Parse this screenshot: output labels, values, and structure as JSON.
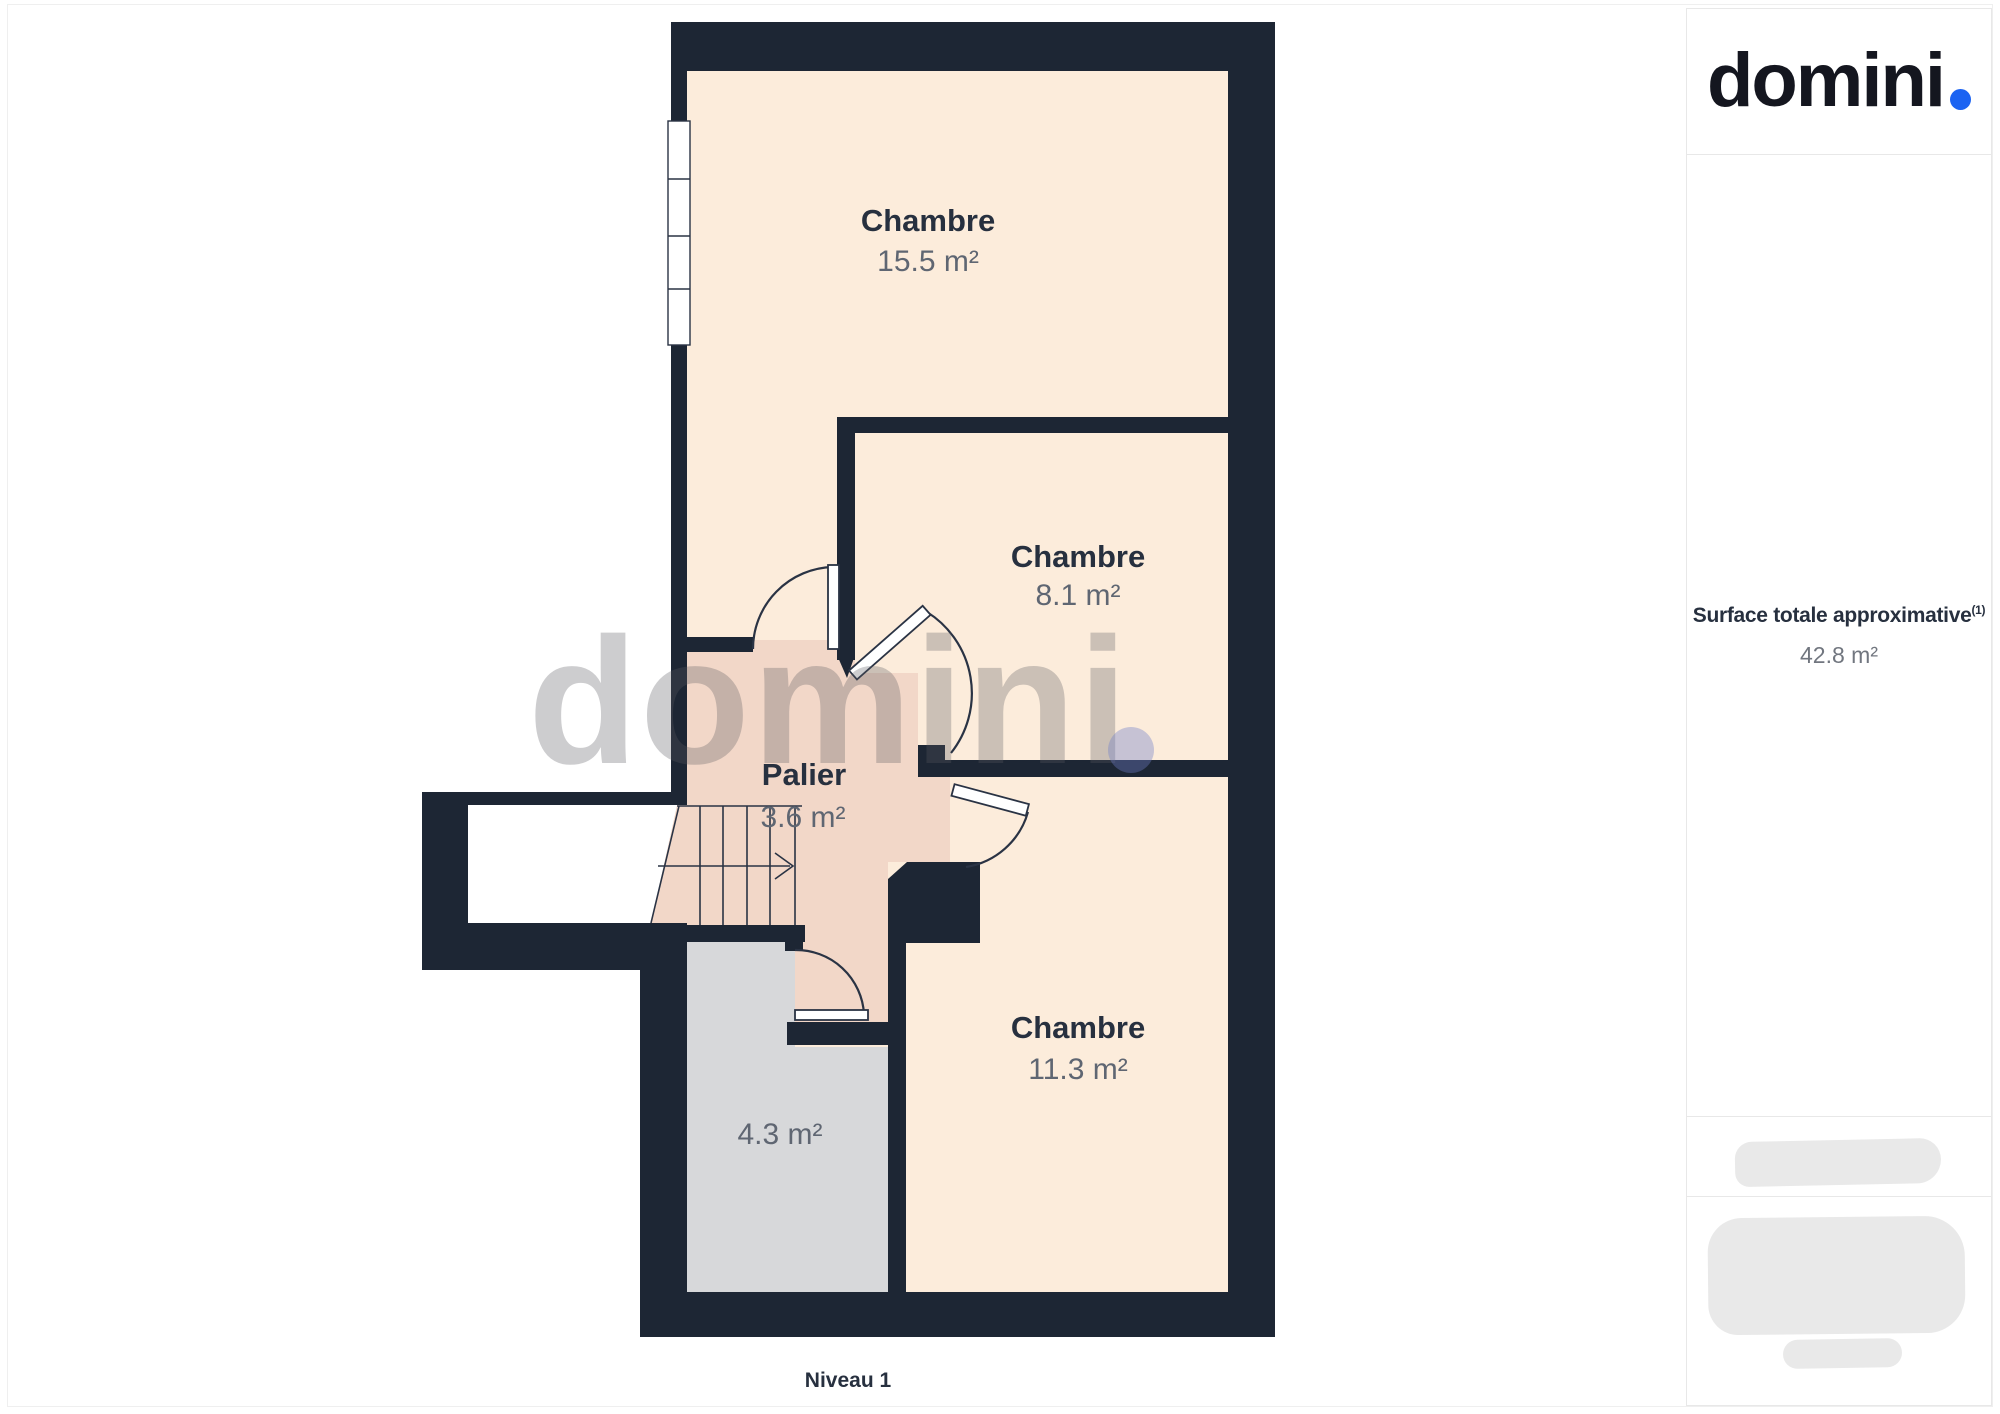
{
  "brand": {
    "logo_text": "domini",
    "accent_color": "#1b63f2"
  },
  "plan": {
    "level_label": "Niveau 1",
    "watermark_text": "domini",
    "rooms": [
      {
        "name": "Chambre",
        "area": "15.5 m²"
      },
      {
        "name": "Chambre",
        "area": "8.1 m²"
      },
      {
        "name": "Chambre",
        "area": "11.3 m²"
      },
      {
        "name": "Palier",
        "area": "3.6 m²"
      },
      {
        "name": "",
        "area": "4.3 m²"
      }
    ]
  },
  "sidebar": {
    "surface_label": "Surface totale approximative",
    "surface_superscript": "(1)",
    "surface_value": "42.8 m²"
  },
  "colors": {
    "wall": "#1d2634",
    "line": "#2a3344",
    "cream": "#fcecdb",
    "pink": "#f2d7c8",
    "grayroom": "#d7d8da",
    "accent": "#1b63f2",
    "logo": "#14161f",
    "label": "#27303f",
    "value": "#5f6672",
    "border": "#e8e8e8",
    "blob": "#e9e9e9"
  }
}
